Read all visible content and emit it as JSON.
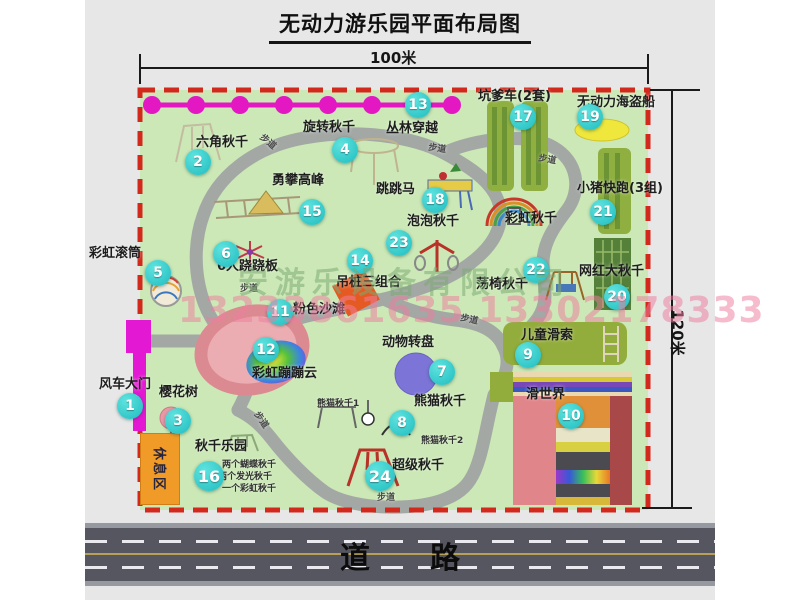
{
  "title": "无动力游乐园平面布局图",
  "dims": {
    "width": "100米",
    "height": "120米"
  },
  "road": {
    "label": "道　　路"
  },
  "rest_area": {
    "label": "休息区"
  },
  "path_label": "步道",
  "rainbow_swing_label": "彩虹秋千",
  "watermark": {
    "company": "安游乐设备有限公司",
    "phones": "13233861635 13302178333"
  },
  "colors": {
    "map_green": "#cbe8b6",
    "border_red": "#d3281c",
    "badge_cyan": "#1fbcc0",
    "zipline_magenta": "#e318c2",
    "gate_magenta": "#e318d2",
    "road_gray": "#565660",
    "rest_orange": "#f09a28",
    "equip_olive": "#8fb040"
  },
  "attractions": [
    {
      "num": "1",
      "label": "风车大门"
    },
    {
      "num": "2",
      "label": "六角秋千"
    },
    {
      "num": "3",
      "label": "樱花树"
    },
    {
      "num": "4",
      "label": "旋转秋千"
    },
    {
      "num": "5",
      "label": "彩虹滚筒"
    },
    {
      "num": "6",
      "label": "6人跷跷板"
    },
    {
      "num": "7",
      "label": "动物转盘"
    },
    {
      "num": "8",
      "label": "熊猫秋千",
      "sub1": "熊猫秋千1",
      "sub2": "熊猫秋千2"
    },
    {
      "num": "9",
      "label": "儿童滑索"
    },
    {
      "num": "10",
      "label": "滑世界"
    },
    {
      "num": "11",
      "label": "粉色沙滩"
    },
    {
      "num": "12",
      "label": "彩虹蹦蹦云"
    },
    {
      "num": "13",
      "label": "丛林穿越"
    },
    {
      "num": "14",
      "label": "吊桩三组合"
    },
    {
      "num": "15",
      "label": "勇攀高峰"
    },
    {
      "num": "16",
      "label": "秋千乐园",
      "notes": [
        "两个蝴蝶秋千",
        "两个发光秋千",
        "一个彩虹秋千"
      ]
    },
    {
      "num": "17",
      "label": "坑爹车(2套)"
    },
    {
      "num": "18",
      "label": "跳跳马"
    },
    {
      "num": "19",
      "label": "无动力海盗船"
    },
    {
      "num": "20",
      "label": "网红大秋千"
    },
    {
      "num": "21",
      "label": "小猪快跑(3组)"
    },
    {
      "num": "22",
      "label": "荡椅秋千"
    },
    {
      "num": "23",
      "label": "泡泡秋千"
    },
    {
      "num": "24",
      "label": "超级秋千"
    }
  ]
}
